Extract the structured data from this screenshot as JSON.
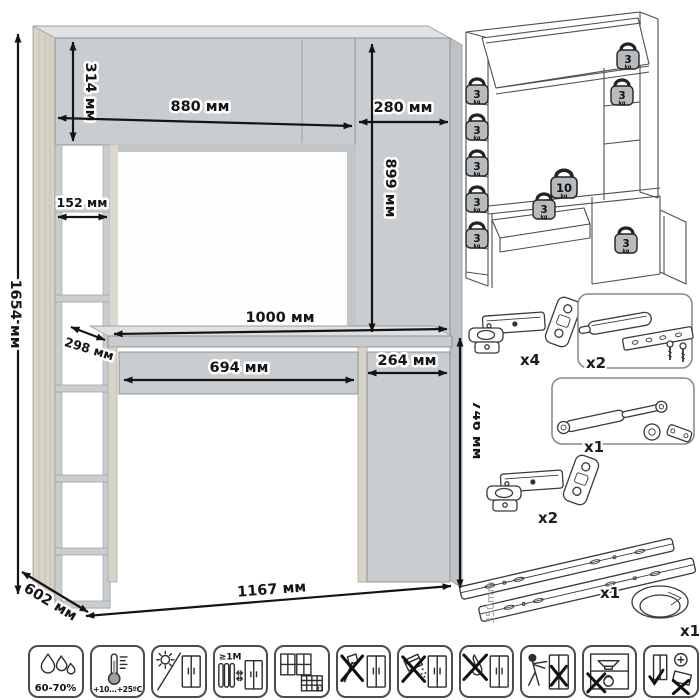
{
  "colors": {
    "panel_front": "#c9cdd0",
    "panel_top": "#e0e2e3",
    "panel_wood": "#d7d2c6",
    "outline": "#8d9194",
    "dimension_text": "#161616",
    "line_art": "#4f4f4f",
    "weight_fill": "#b7bbbd"
  },
  "dims": {
    "total_height": "1654 мм",
    "top_cabinet_height": "314 мм",
    "top_cabinet_width": "880 мм",
    "right_cabinet_width": "280 мм",
    "right_cabinet_height": "899 мм",
    "shelf_width": "152 мм",
    "shelf_depth": "298 мм",
    "desktop_width": "1000 мм",
    "drawer_width": "694 мм",
    "door_width": "264 мм",
    "desk_height": "746 мм",
    "depth": "602 мм",
    "total_width": "1167 мм"
  },
  "load": {
    "weights": [
      {
        "name": "left-shelf-1",
        "value": "3",
        "unit": "kg"
      },
      {
        "name": "left-shelf-2",
        "value": "3",
        "unit": "kg"
      },
      {
        "name": "left-shelf-3",
        "value": "3",
        "unit": "kg"
      },
      {
        "name": "left-shelf-4",
        "value": "3",
        "unit": "kg"
      },
      {
        "name": "left-shelf-5",
        "value": "3",
        "unit": "kg"
      },
      {
        "name": "top-shelf",
        "value": "3",
        "unit": "kg"
      },
      {
        "name": "right-shelf",
        "value": "3",
        "unit": "kg"
      },
      {
        "name": "desktop",
        "value": "10",
        "unit": "kg"
      },
      {
        "name": "drawer",
        "value": "3",
        "unit": "kg"
      },
      {
        "name": "pedestal",
        "value": "3",
        "unit": "kg"
      }
    ]
  },
  "hardware": {
    "items": [
      {
        "name": "hinge",
        "qty": "x4"
      },
      {
        "name": "door-damper",
        "qty": "x2"
      },
      {
        "name": "gas-lift",
        "qty": "x1"
      },
      {
        "name": "hinge",
        "qty": "x2"
      },
      {
        "name": "drawer-slides",
        "qty": "x1",
        "size": "350mm"
      },
      {
        "name": "cable-grommet",
        "qty": "x1"
      }
    ]
  },
  "care": {
    "icons": [
      {
        "name": "humidity",
        "label": "60-70%"
      },
      {
        "name": "temperature",
        "label": "+10...+25ºC"
      },
      {
        "name": "no-direct-sunlight",
        "label": ""
      },
      {
        "name": "heater-distance",
        "label": "≥1М"
      },
      {
        "name": "ventilation-calendar",
        "label": "21"
      },
      {
        "name": "no-sharp-impact",
        "label": ""
      },
      {
        "name": "no-abrasives",
        "label": ""
      },
      {
        "name": "no-open-flame",
        "label": ""
      },
      {
        "name": "do-not-drag",
        "label": ""
      },
      {
        "name": "no-heavy-load",
        "label": ""
      },
      {
        "name": "keep-upright",
        "label": ""
      }
    ]
  }
}
